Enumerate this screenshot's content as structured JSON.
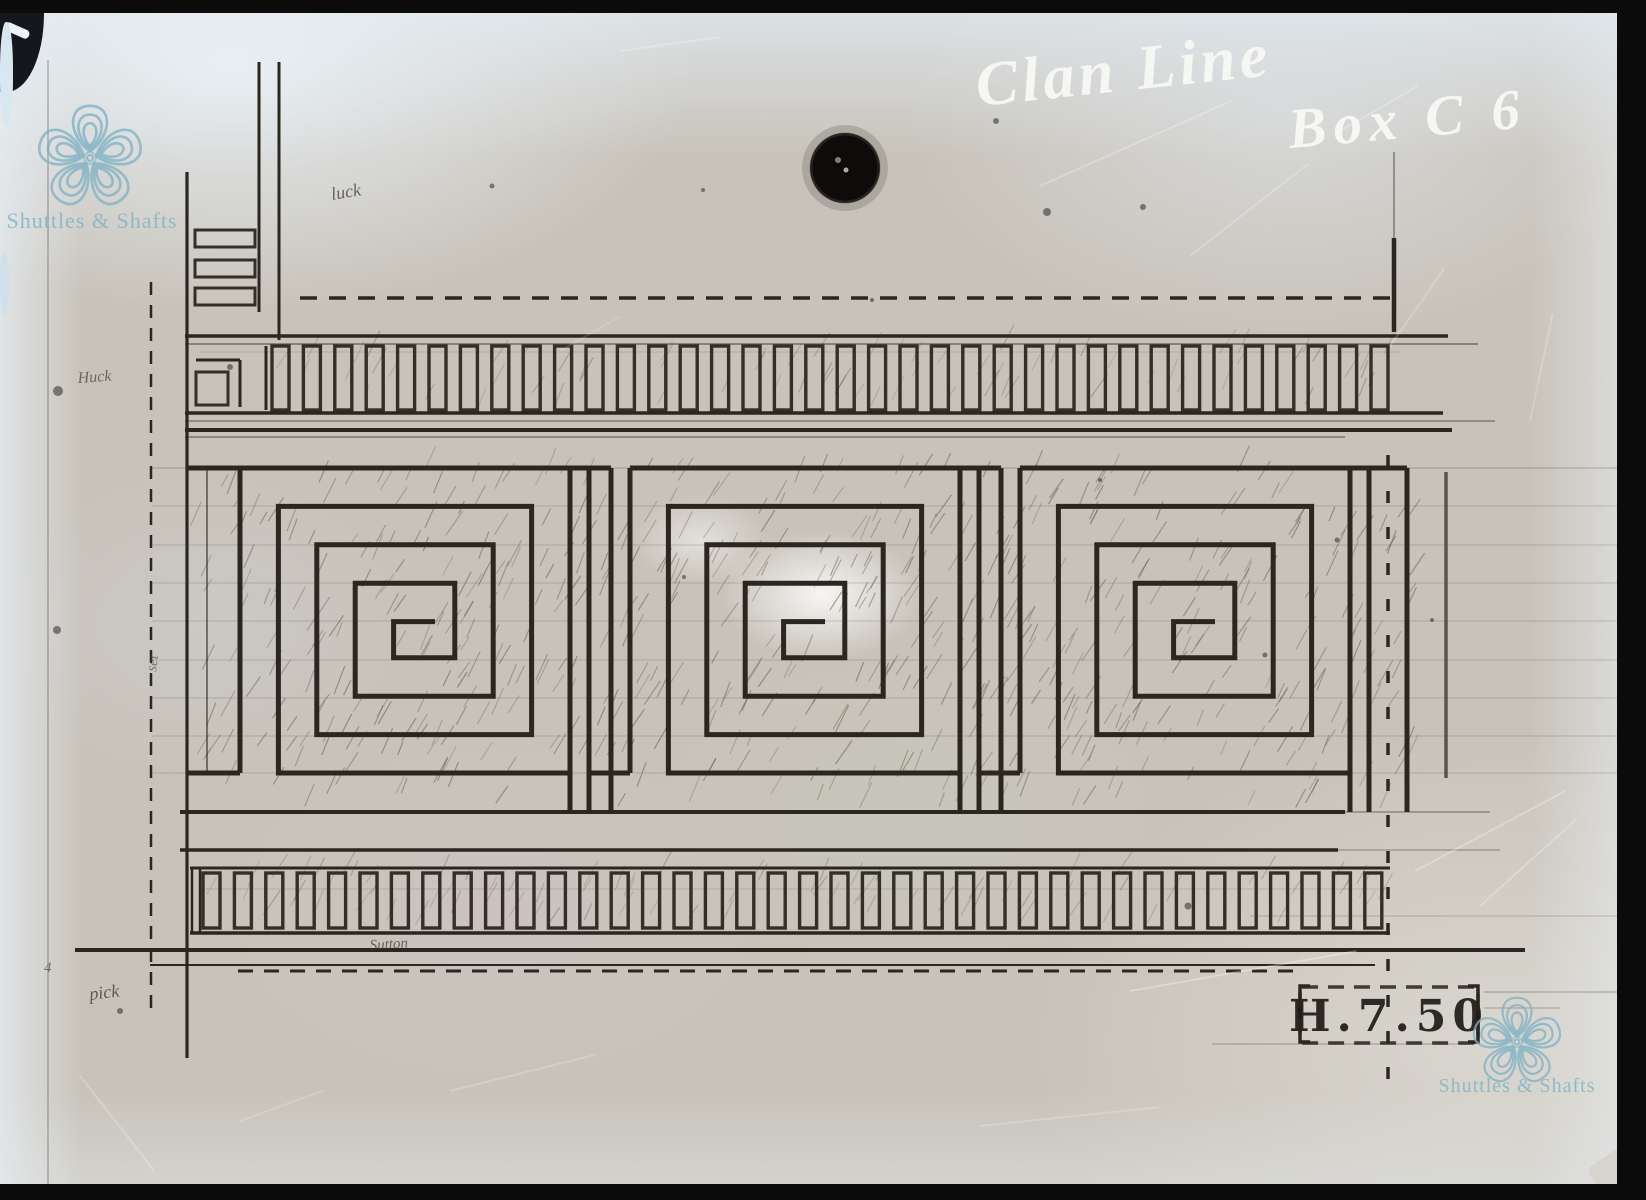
{
  "artifact": {
    "kind": "glass-plate photograph of a woven-border design drawing",
    "pattern": "Greek key meander band between two dentil borders"
  },
  "annotations": {
    "handwriting_line1": "Clan Line",
    "handwriting_line2": "Box C 6",
    "stamp_code": "H.7.50",
    "pencil_note_top": "luck",
    "pencil_note_left": "Huck",
    "pencil_note_left_vertical": "set",
    "pencil_note_signature": "Sutton",
    "pencil_note_bottom_left": "pick",
    "pencil_note_corner": "4"
  },
  "watermark": {
    "text": "Shuttles & Shafts",
    "logo": "celtic-knot-flower",
    "color": "#7fb2c5"
  },
  "colors": {
    "plate": "#c8c3ba",
    "ink": "#2b261f",
    "pencil": "#453f35",
    "handwriting": "#f9f9f5",
    "frame": "#0b0b0c",
    "watermark": "#7fb2c5"
  }
}
